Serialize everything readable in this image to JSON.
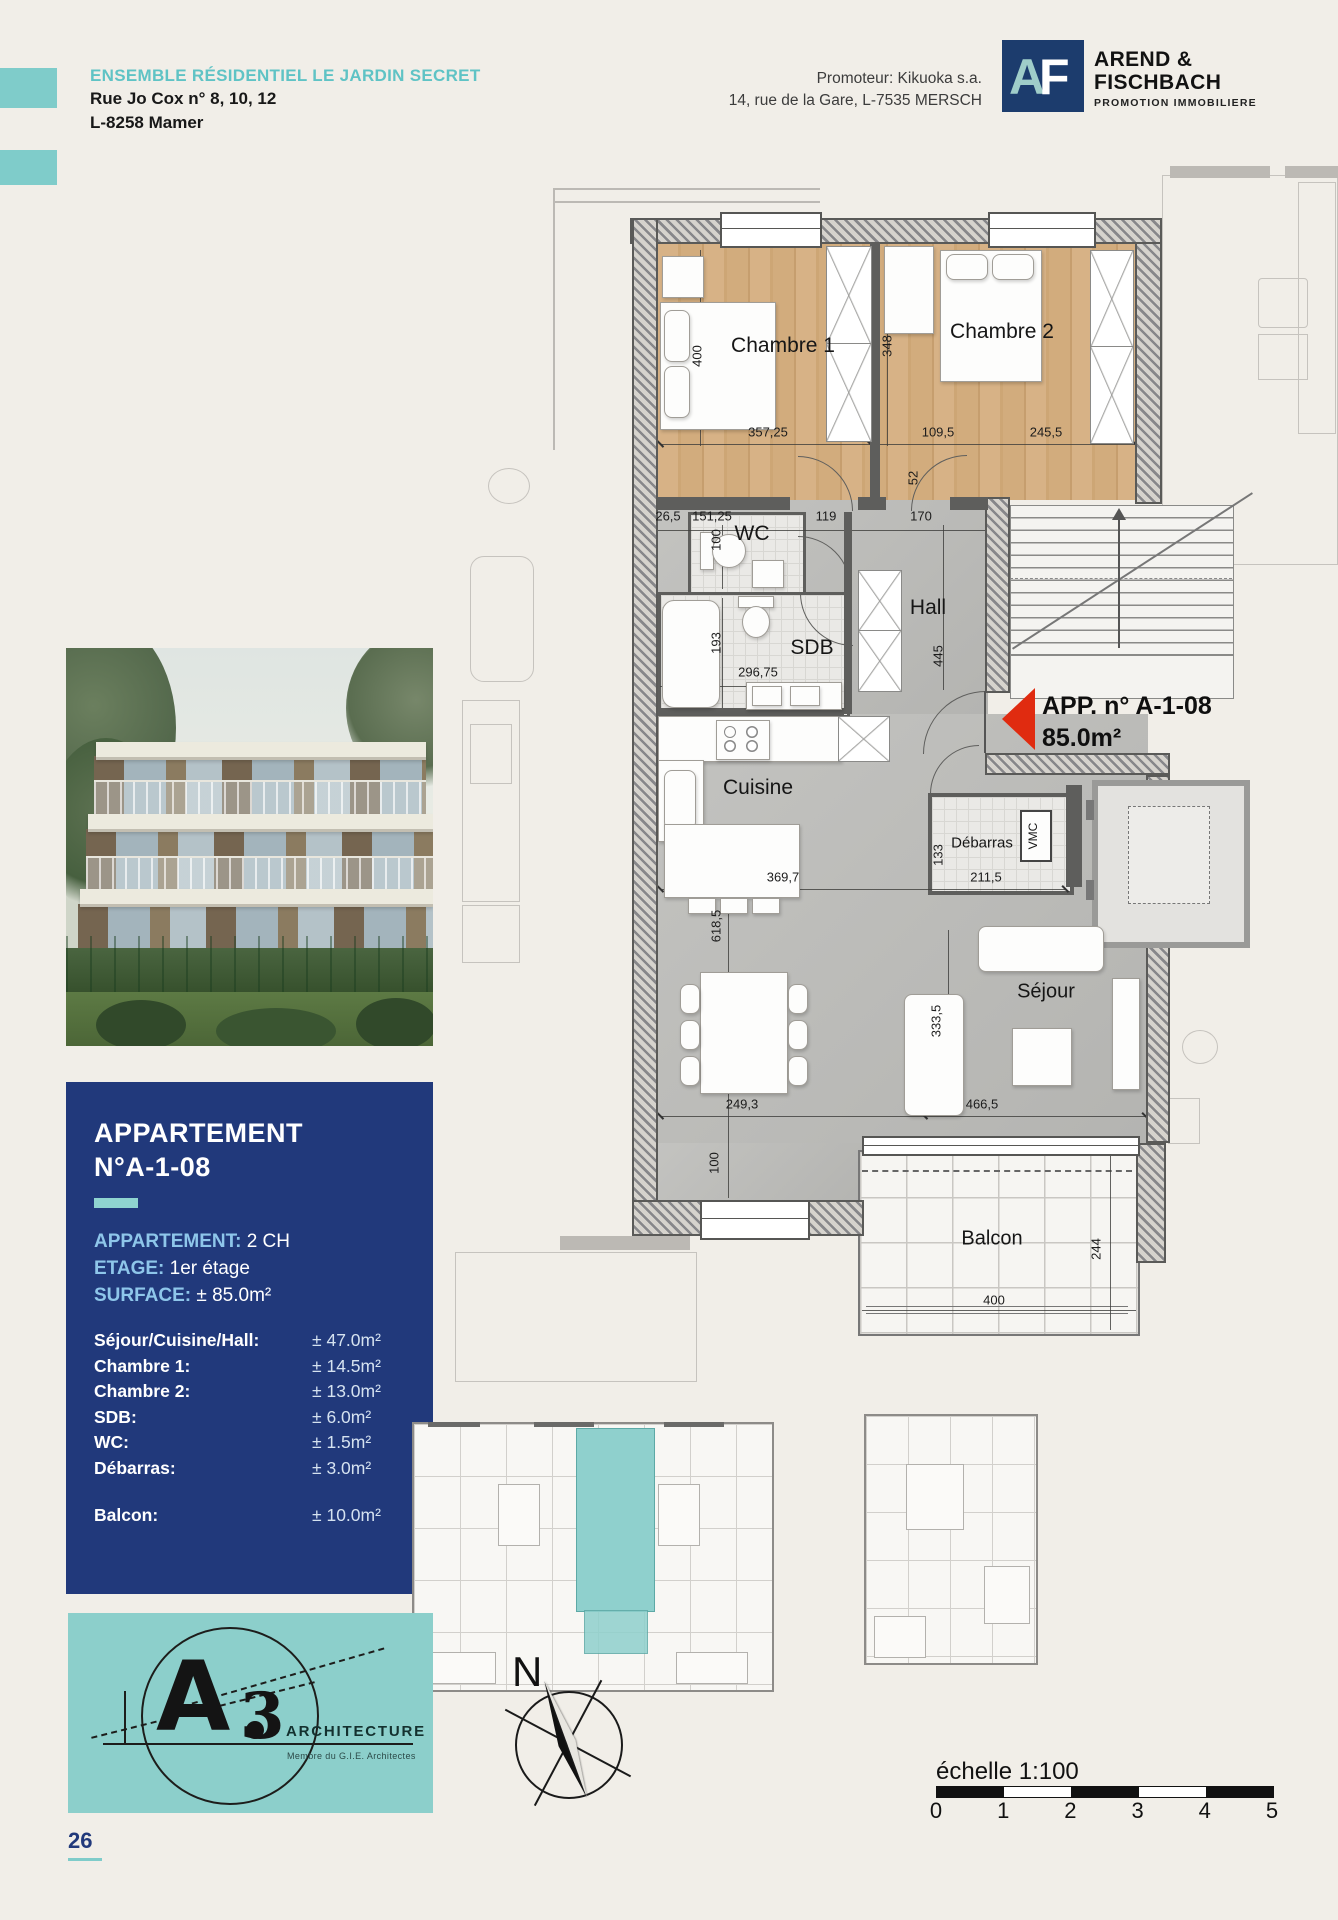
{
  "header": {
    "title": "ENSEMBLE RÉSIDENTIEL LE JARDIN SECRET",
    "address_line1": "Rue Jo Cox n° 8, 10, 12",
    "address_line2": "L-8258 Mamer",
    "promoter_line1": "Promoteur: Kikuoka s.a.",
    "promoter_line2": "14, rue de la Gare, L-7535 MERSCH",
    "logo": {
      "letter_a": "A",
      "letter_f": "F",
      "name_line1": "AREND &",
      "name_line2": "FISCHBACH",
      "tagline": "PROMOTION IMMOBILIERE",
      "brand_navy": "#1c3c6d",
      "brand_teal": "#9fcdc9"
    }
  },
  "info_panel": {
    "title_line1": "APPARTEMENT",
    "title_line2": "N°A-1-08",
    "panel_color": "#21397b",
    "accent_teal": "#8fd4d0",
    "label_blue": "#8ec6ea",
    "specs": [
      {
        "label": "APPARTEMENT:",
        "value": "2 CH"
      },
      {
        "label": "ETAGE:",
        "value": "1er étage"
      },
      {
        "label": "SURFACE:",
        "value": "± 85.0m²"
      }
    ],
    "rooms": [
      {
        "label": "Séjour/Cuisine/Hall:",
        "value": "± 47.0m²"
      },
      {
        "label": "Chambre 1:",
        "value": "± 14.5m²"
      },
      {
        "label": "Chambre 2:",
        "value": "± 13.0m²"
      },
      {
        "label": "SDB:",
        "value": "± 6.0m²"
      },
      {
        "label": "WC:",
        "value": "± 1.5m²"
      },
      {
        "label": "Débarras:",
        "value": "± 3.0m²"
      }
    ],
    "balcony": {
      "label": "Balcon:",
      "value": "± 10.0m²"
    }
  },
  "plan": {
    "unit_label_line1": "APP. n° A-1-08",
    "unit_label_line2": "85.0m²",
    "arrow_color": "#e02b10",
    "room_labels": [
      {
        "text": "Chambre 1",
        "x": 783,
        "y": 346,
        "size": 21
      },
      {
        "text": "Chambre 2",
        "x": 1002,
        "y": 332,
        "size": 21
      },
      {
        "text": "WC",
        "x": 752,
        "y": 534,
        "size": 21
      },
      {
        "text": "SDB",
        "x": 812,
        "y": 648,
        "size": 21
      },
      {
        "text": "Hall",
        "x": 928,
        "y": 608,
        "size": 21
      },
      {
        "text": "Cuisine",
        "x": 758,
        "y": 788,
        "size": 21
      },
      {
        "text": "Débarras",
        "x": 982,
        "y": 843,
        "size": 15
      },
      {
        "text": "VMC",
        "x": 1033,
        "y": 836,
        "size": 12,
        "rot": 1
      },
      {
        "text": "Séjour",
        "x": 1046,
        "y": 992,
        "size": 20
      },
      {
        "text": "Balcon",
        "x": 992,
        "y": 1239,
        "size": 20
      }
    ],
    "dimensions": [
      {
        "t": "400",
        "x": 697,
        "y": 356,
        "r": 1
      },
      {
        "t": "357,25",
        "x": 768,
        "y": 432
      },
      {
        "t": "348",
        "x": 887,
        "y": 346,
        "r": 1
      },
      {
        "t": "109,5",
        "x": 938,
        "y": 432
      },
      {
        "t": "245,5",
        "x": 1046,
        "y": 432
      },
      {
        "t": "52",
        "x": 913,
        "y": 478,
        "r": 1
      },
      {
        "t": "26,5",
        "x": 668,
        "y": 516
      },
      {
        "t": "151,25",
        "x": 712,
        "y": 516
      },
      {
        "t": "119",
        "x": 826,
        "y": 516
      },
      {
        "t": "170",
        "x": 921,
        "y": 516
      },
      {
        "t": "100",
        "x": 716,
        "y": 540,
        "r": 1
      },
      {
        "t": "193",
        "x": 716,
        "y": 643,
        "r": 1
      },
      {
        "t": "296,75",
        "x": 758,
        "y": 672
      },
      {
        "t": "445",
        "x": 938,
        "y": 656,
        "r": 1
      },
      {
        "t": "369,7",
        "x": 783,
        "y": 877
      },
      {
        "t": "618,5",
        "x": 716,
        "y": 926,
        "r": 1
      },
      {
        "t": "133",
        "x": 938,
        "y": 855,
        "r": 1
      },
      {
        "t": "211,5",
        "x": 986,
        "y": 877
      },
      {
        "t": "249,3",
        "x": 742,
        "y": 1104
      },
      {
        "t": "333,5",
        "x": 936,
        "y": 1021,
        "r": 1
      },
      {
        "t": "466,5",
        "x": 982,
        "y": 1104
      },
      {
        "t": "100",
        "x": 714,
        "y": 1163,
        "r": 1
      },
      {
        "t": "244",
        "x": 1096,
        "y": 1249,
        "r": 1
      },
      {
        "t": "400",
        "x": 994,
        "y": 1300
      }
    ]
  },
  "footer": {
    "page_number": "26",
    "compass_label": "N",
    "scale": {
      "label": "échelle 1:100",
      "ticks": [
        "0",
        "1",
        "2",
        "3",
        "4",
        "5"
      ]
    },
    "architect_logo": {
      "letter": "A",
      "digit": "3",
      "name": "ARCHITECTURE",
      "subtext": "Membre du G.I.E. Architectes",
      "box_teal": "#8ccfcb"
    }
  }
}
